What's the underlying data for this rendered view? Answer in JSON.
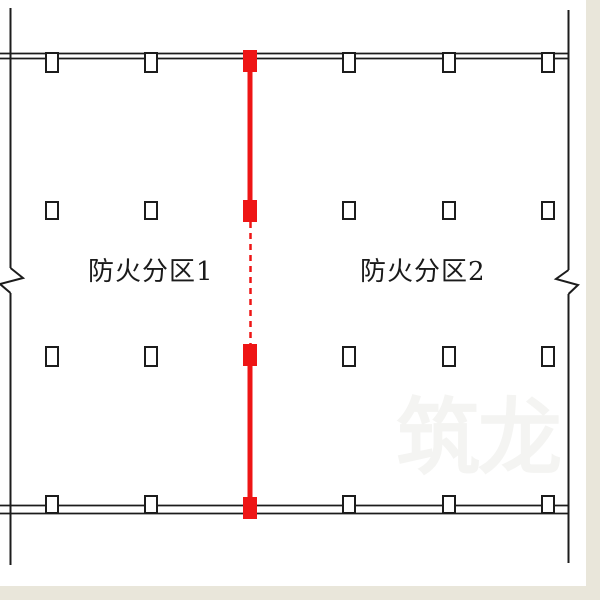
{
  "diagram": {
    "labels": {
      "zone1": "防火分区1",
      "zone2": "防火分区2"
    },
    "watermark": "筑龙",
    "colors": {
      "fire_line": "#ee1515",
      "drawing_line": "#1c1c1c",
      "canvas": "#ffffff",
      "frame": "#e9e6da"
    }
  }
}
